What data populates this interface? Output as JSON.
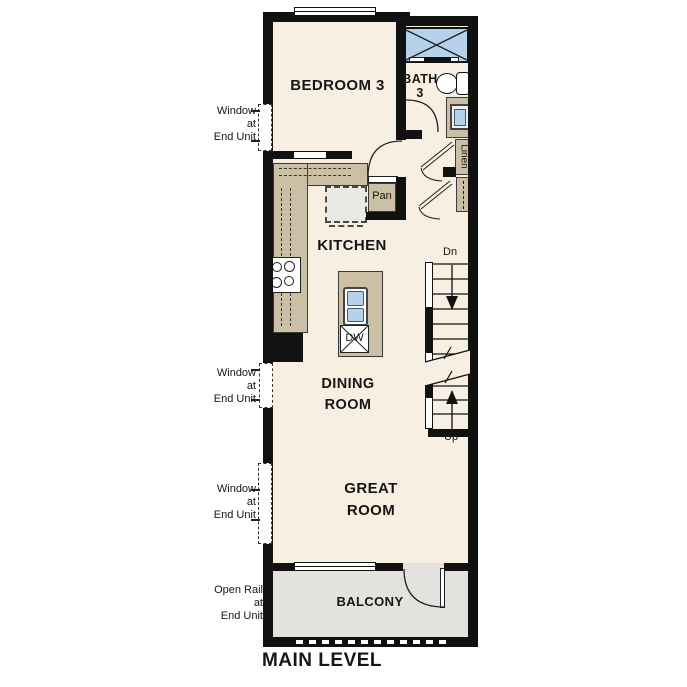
{
  "title": "MAIN LEVEL",
  "rooms": {
    "bedroom3": "BEDROOM 3",
    "bath3": "BATH\n3",
    "kitchen": "KITCHEN",
    "dining": "DINING\nROOM",
    "great": "GREAT\nROOM",
    "balcony": "BALCONY"
  },
  "fixtures": {
    "pantry": "Pan",
    "dishwasher": "DW",
    "linen": "Linen"
  },
  "stairs": {
    "down": "Dn",
    "up": "Up"
  },
  "annotations": {
    "window_note": "Window\nat\nEnd Unit",
    "open_rail_note": "Open Rail\nat\nEnd Unit"
  },
  "colors": {
    "wall": "#111111",
    "floor": "#f7efe1",
    "counter_tan": "#cbbfa6",
    "balcony_gray": "#e3e2df",
    "fixture_blue": "#b6d1ea",
    "appliance_gray": "#e9e9e6"
  }
}
